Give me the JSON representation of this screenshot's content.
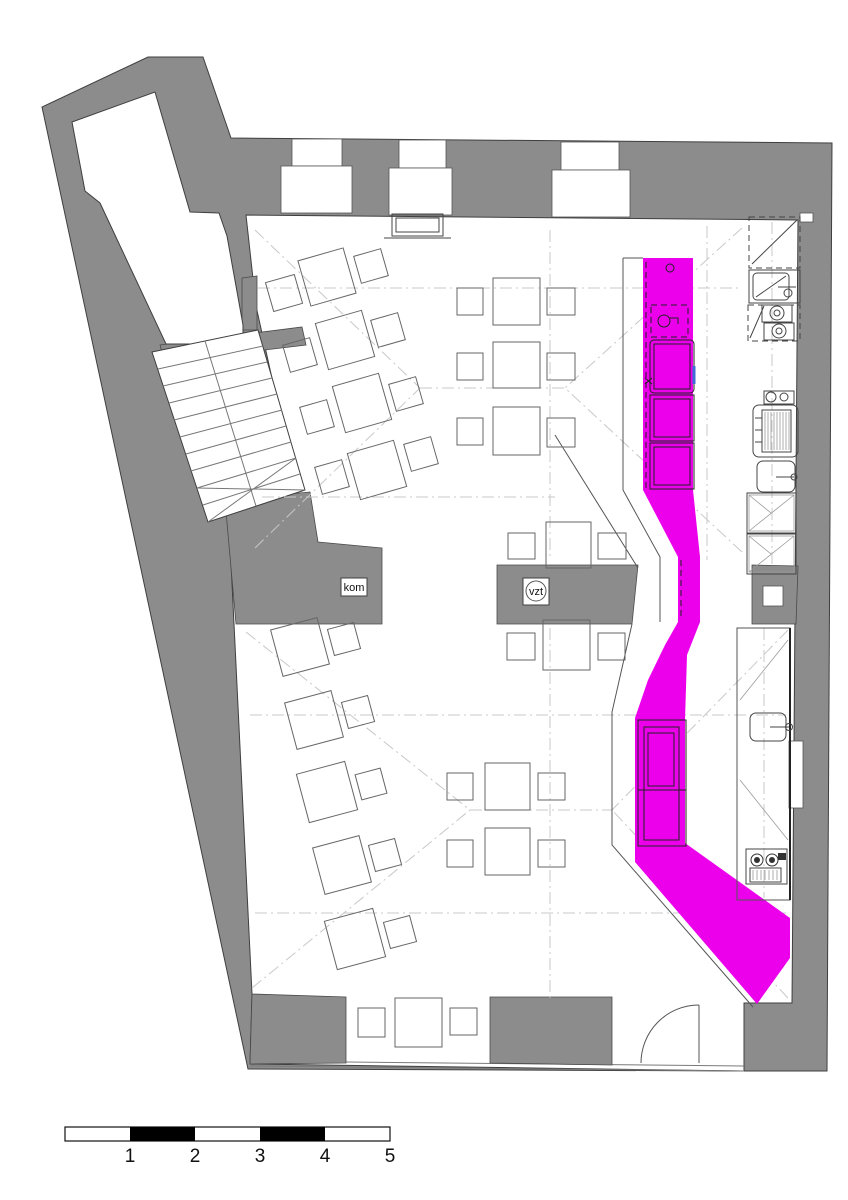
{
  "plan": {
    "type": "architectural-floor-plan",
    "labels": {
      "chimney": "kom",
      "ventilation": "vzt"
    },
    "highlighted_element": "bar-counter",
    "colors": {
      "wall_gray": "#8c8c8c",
      "bar_highlight": "#ec00ec",
      "drawing_line": "#444444",
      "vault_line": "#c8c8c8",
      "accent_blue": "#3b6fd4"
    }
  },
  "scalebar": {
    "labels": [
      "1",
      "2",
      "3",
      "4",
      "5"
    ]
  }
}
